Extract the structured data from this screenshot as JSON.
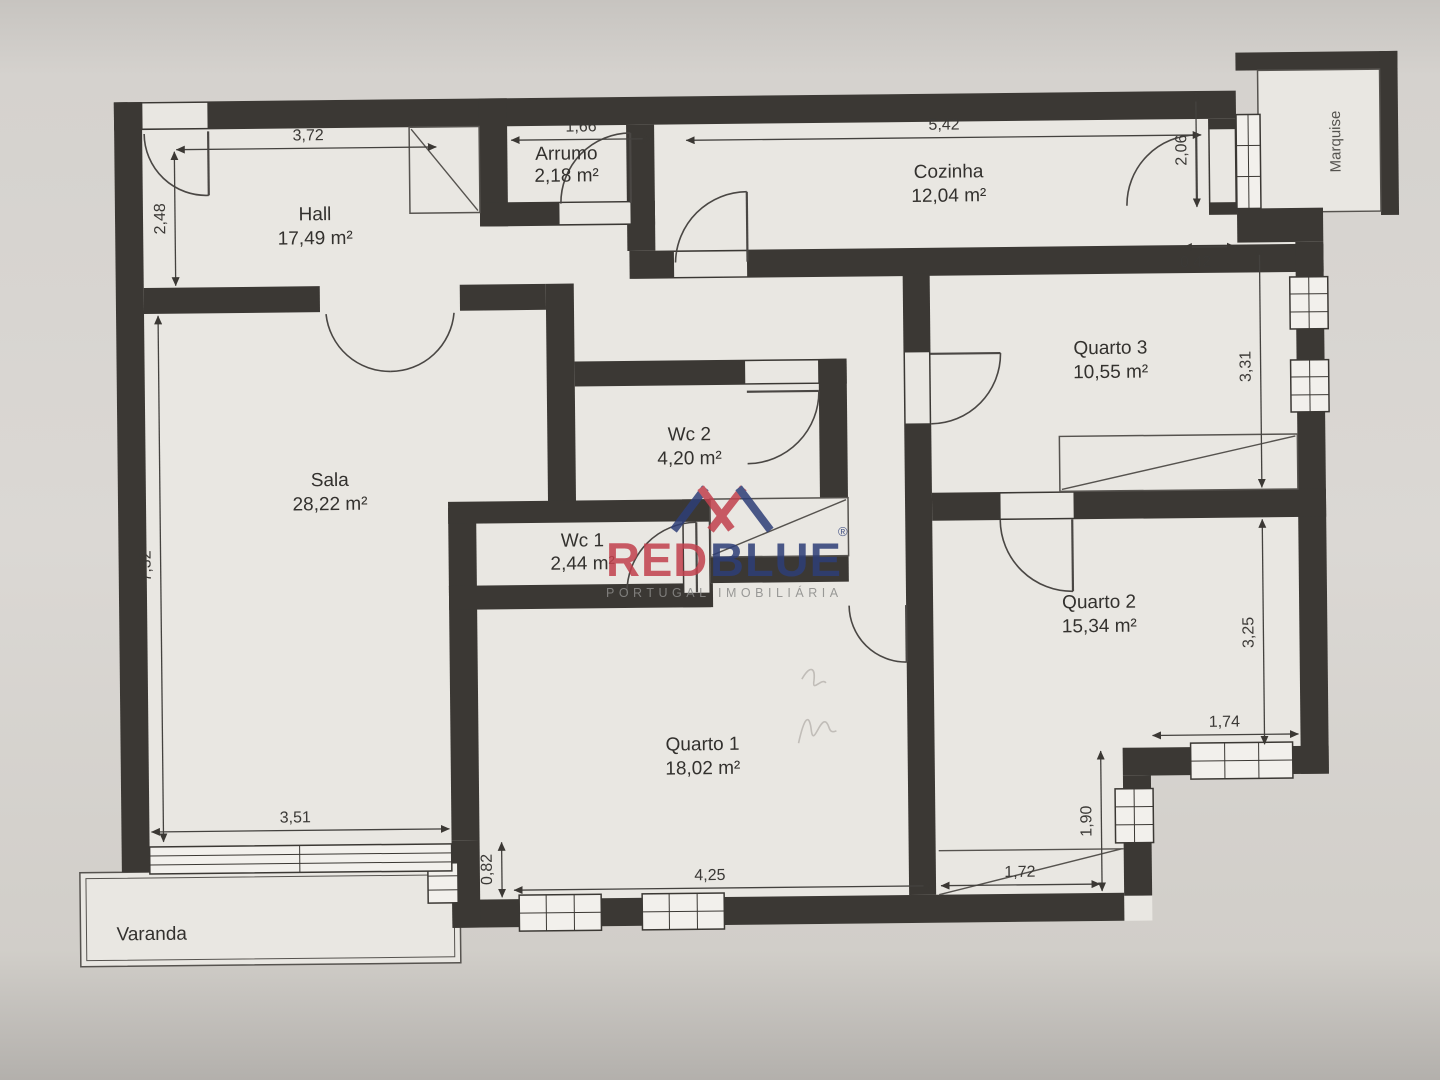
{
  "rooms": [
    {
      "id": "hall",
      "name": "Hall",
      "area": "17,49 m²"
    },
    {
      "id": "arrumo",
      "name": "Arrumo",
      "area": "2,18 m²"
    },
    {
      "id": "cozinha",
      "name": "Cozinha",
      "area": "12,04 m²"
    },
    {
      "id": "quarto3",
      "name": "Quarto 3",
      "area": "10,55 m²"
    },
    {
      "id": "wc2",
      "name": "Wc 2",
      "area": "4,20 m²"
    },
    {
      "id": "wc1",
      "name": "Wc 1",
      "area": "2,44 m²"
    },
    {
      "id": "sala",
      "name": "Sala",
      "area": "28,22 m²"
    },
    {
      "id": "quarto2",
      "name": "Quarto 2",
      "area": "15,34 m²"
    },
    {
      "id": "quarto1",
      "name": "Quarto 1",
      "area": "18,02 m²"
    },
    {
      "id": "varanda",
      "name": "Varanda",
      "area": ""
    },
    {
      "id": "marquise",
      "name": "Marquise",
      "area": ""
    }
  ],
  "dimensions_m": {
    "top_hall": "3,72",
    "top_arrumo": "1,66",
    "top_cozinha": "5,42",
    "left_entry": "2,48",
    "marquise_door": "2,06",
    "step_q3": "0,42",
    "q3_height": "3,31",
    "sala_height": "7,32",
    "q2_height": "3,25",
    "q2_window": "1,74",
    "q2_closet_h": "1,90",
    "q1_closet_w": "1,72",
    "sala_window": "3,51",
    "q1_step": "0,82",
    "q1_width": "4,25"
  },
  "watermark": {
    "word_red": "RED",
    "word_blue": "BLUE",
    "registered": "®",
    "tagline": "PORTUGAL IMOBILIÁRIA",
    "red": "#c2414d",
    "blue": "#2e3e78"
  },
  "palette": {
    "paper": "#d6d3cf",
    "floor": "#e9e7e2",
    "wall": "#3b3834",
    "line": "#4a4744"
  }
}
